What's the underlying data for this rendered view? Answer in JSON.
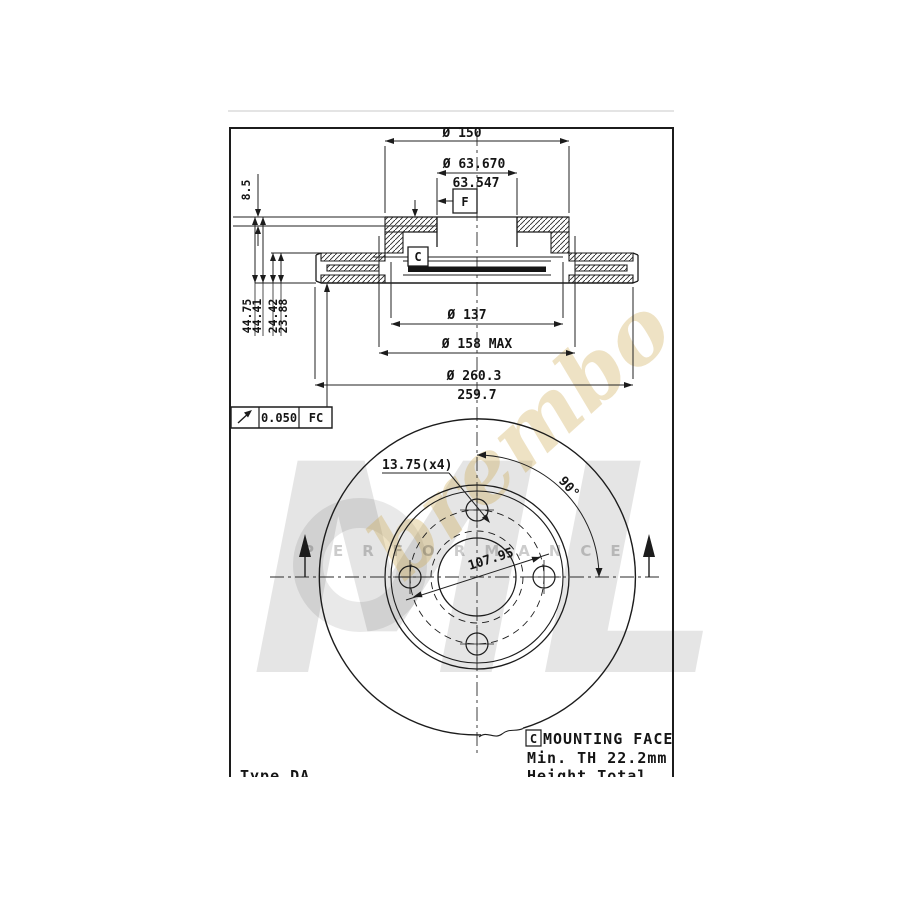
{
  "watermark": {
    "big": "ML",
    "script": "brembo",
    "performance": "PERFORMANCE"
  },
  "section": {
    "d150": "Ø 150",
    "bore_upper": "Ø 63.670",
    "bore_lower": "63.547",
    "offset": "8.5",
    "h_outer_a": "44.75",
    "h_outer_b": "44.41",
    "th_a": "24.42",
    "th_b": "23.88",
    "d137": "Ø 137",
    "d158": "Ø 158 MAX",
    "od_a": "Ø 260.3",
    "od_b": "259.7",
    "datum_f": "F",
    "datum_c": "C"
  },
  "runout": {
    "value": "0.050",
    "datum": "FC"
  },
  "front": {
    "bolt_holes": "13.75(x4)",
    "angle": "90°",
    "pcd": "107.95"
  },
  "notes": {
    "datum_c": "C",
    "mounting_face": "MOUNTING FACE",
    "min_th": "Min. TH 22.2mm",
    "bottom_right_clipped": "Height Total",
    "bottom_left_clipped": "Type DA"
  },
  "colors": {
    "line": "#1c1c1c",
    "faint": "#dcdcdc",
    "watermark_gray": "#d9d9d9",
    "watermark_tan": "#d8b86a"
  }
}
